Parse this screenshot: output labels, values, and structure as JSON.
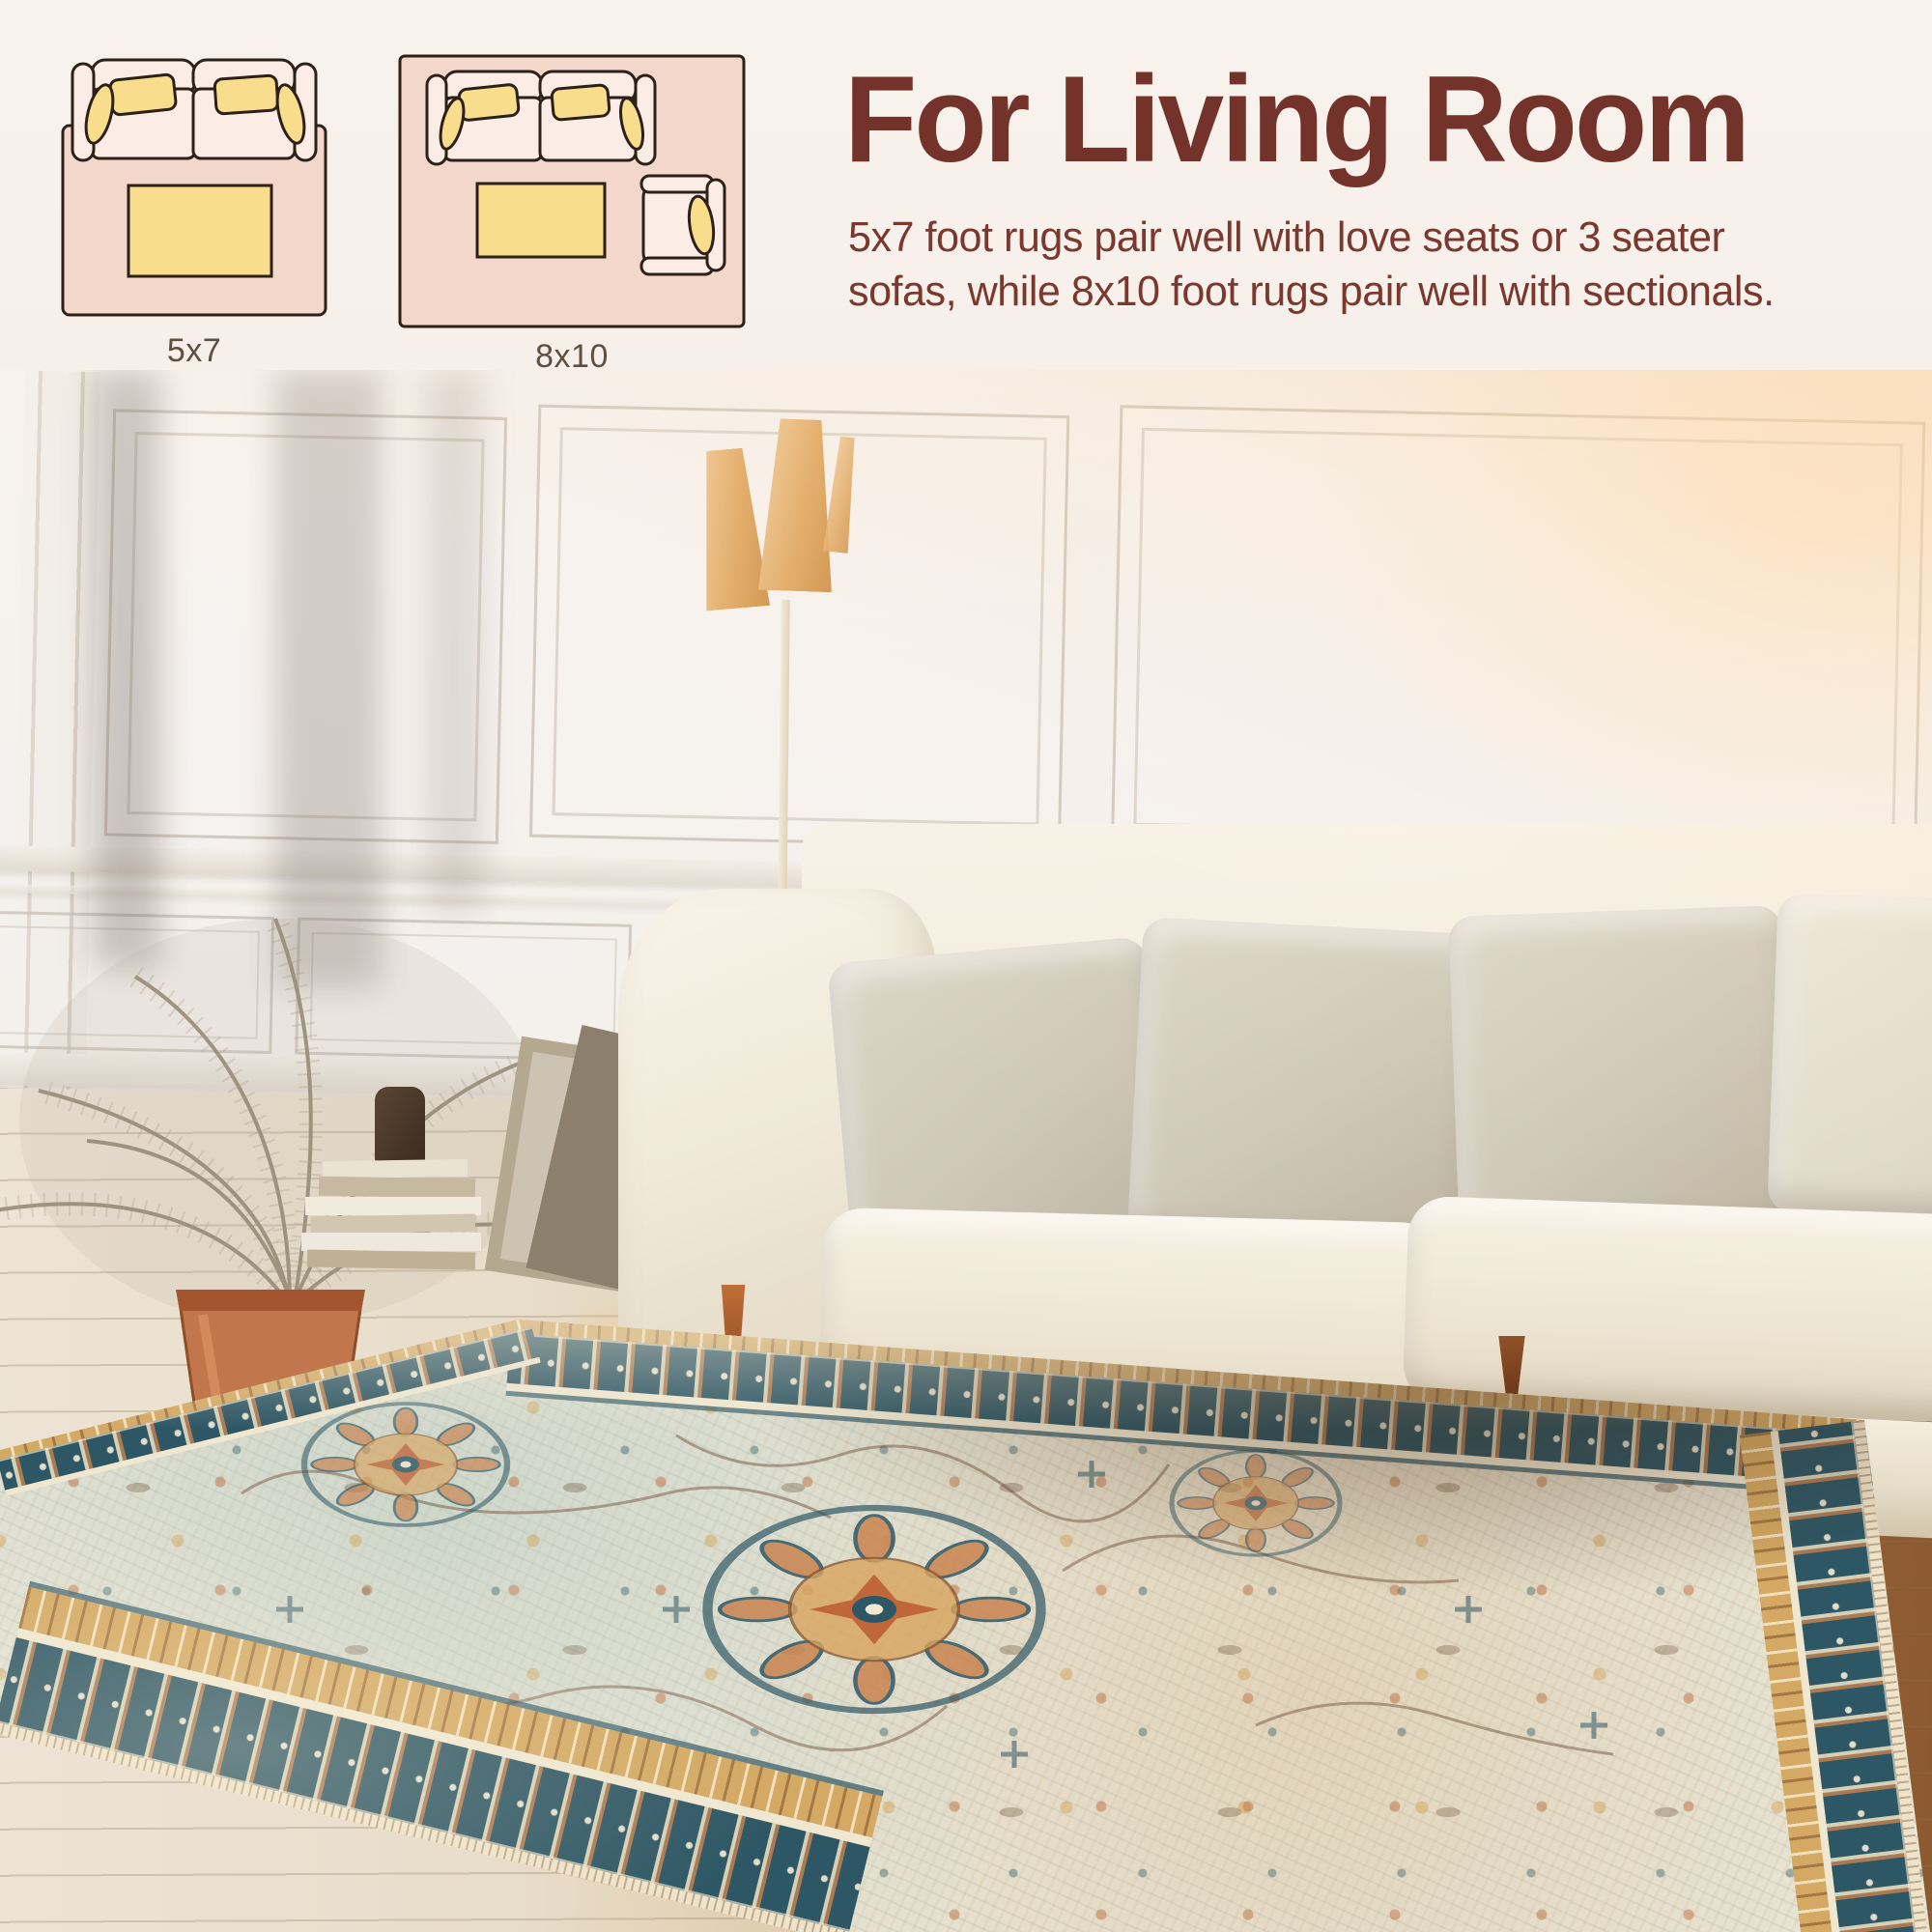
{
  "banner": {
    "heading": "For Living Room",
    "body_line1": "5x7 foot rugs pair well with love seats or 3 seater",
    "body_line2": "sofas, while 8x10 foot rugs pair well with sectionals.",
    "diagrams": [
      {
        "label": "5x7",
        "icon": "rug-5x7-top-view-icon"
      },
      {
        "label": "8x10",
        "icon": "rug-8x10-top-view-icon"
      }
    ]
  },
  "colors": {
    "banner_background": "#F8F1EB",
    "heading_text": "#73322A",
    "body_text": "#7A382E",
    "diagram_label_text": "#5E4F41",
    "diagram_rug_pink": "#F2D7CA",
    "diagram_furniture_fill": "#FBEDE6",
    "diagram_cushion_yellow": "#F8DE8C",
    "diagram_outline": "#2B2118",
    "rug_field_ivory": "#E9E6D7",
    "rug_border_teal": "#2E5765",
    "rug_accent_rust": "#BC5F33",
    "rug_accent_gold": "#D3A963",
    "sofa_cream": "#F3EDDF",
    "pillow_greige": "#CFC8B7",
    "lamp_shade_tan": "#E0A964",
    "pot_terracotta": "#C1764B",
    "floor_wood_warm": "#9D6838"
  }
}
